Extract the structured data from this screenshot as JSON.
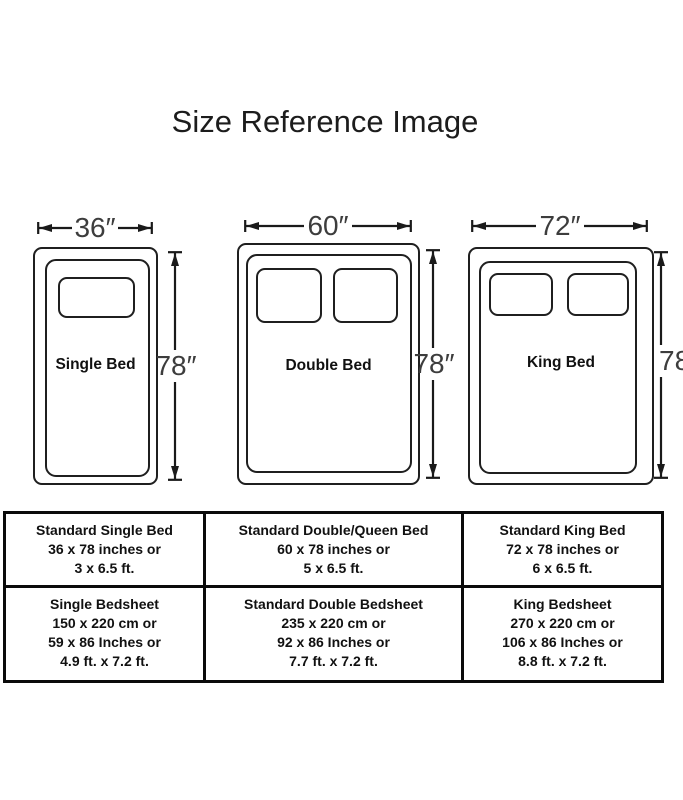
{
  "title": "Size Reference Image",
  "beds": [
    {
      "name": "Single Bed",
      "width_label": "36″",
      "height_label": "78″",
      "pillow_count": 1
    },
    {
      "name": "Double Bed",
      "width_label": "60″",
      "height_label": "78″",
      "pillow_count": 2
    },
    {
      "name": "King Bed",
      "width_label": "72″",
      "height_label": "78″",
      "pillow_count": 2
    }
  ],
  "table": {
    "rows": [
      {
        "cells": [
          {
            "lines": [
              "Standard Single Bed",
              "36 x 78 inches or",
              "3 x 6.5 ft."
            ]
          },
          {
            "lines": [
              "Standard Double/Queen Bed",
              "60 x 78 inches or",
              "5 x 6.5 ft."
            ]
          },
          {
            "lines": [
              "Standard King Bed",
              "72 x 78 inches or",
              "6 x 6.5 ft."
            ]
          }
        ]
      },
      {
        "cells": [
          {
            "lines": [
              "Single Bedsheet",
              "150 x 220 cm or",
              "59 x 86 Inches or",
              "4.9 ft. x 7.2 ft."
            ]
          },
          {
            "lines": [
              "Standard Double Bedsheet",
              "235 x 220 cm or",
              "92 x 86 Inches or",
              "7.7 ft. x 7.2 ft."
            ]
          },
          {
            "lines": [
              "King Bedsheet",
              "270 x 220 cm or",
              "106 x 86 Inches or",
              "8.8 ft. x 7.2 ft."
            ]
          }
        ]
      }
    ]
  },
  "colors": {
    "line": "#1a1a1a",
    "dimension_text": "#3d3d3d",
    "table_border": "#0a0a0a"
  }
}
